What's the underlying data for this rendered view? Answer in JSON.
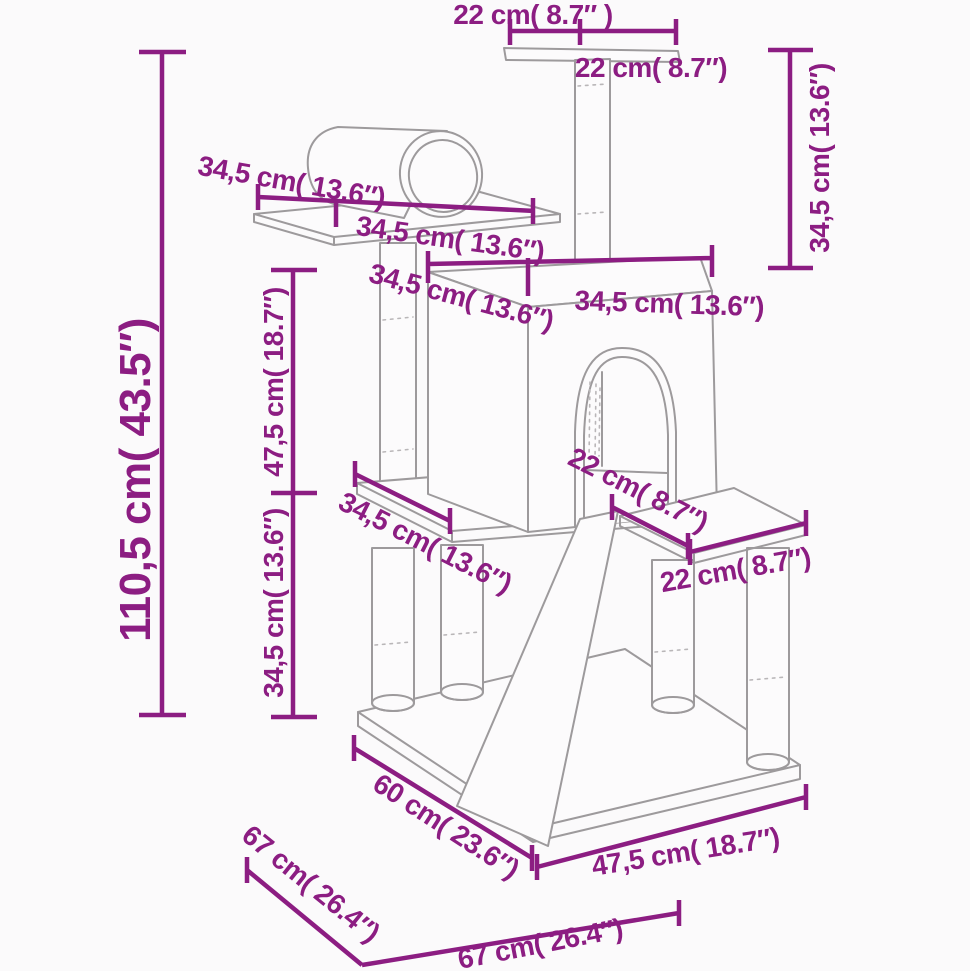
{
  "figure": {
    "type": "product dimension diagram",
    "subject": "cat tree with scratching posts, house, tunnel, ramp and perch"
  },
  "colors": {
    "dimension_accent": "#8C1D82",
    "line_art": "#9D9A9C",
    "background": "#FBFAFB"
  },
  "labels": {
    "top_width_left": "22 cm( 8.7″ )",
    "top_width_right": "22 cm( 8.7″)",
    "top_post_height": "34,5 cm( 13.6″)",
    "tunnel_length": "34,5 cm( 13.6″)",
    "tunnel_platform_width": "34,5 cm( 13.6″)",
    "house_depth": "34,5 cm( 13.6″)",
    "house_width": "34,5 cm( 13.6″)",
    "total_height": "110,5 cm( 43.5″)",
    "upper_section_height": "47,5 cm( 18.7″)",
    "lower_section_height": "34,5 cm( 13.6″)",
    "right_platform_depth": "22 cm( 8.7″)",
    "left_platform_width": "34,5 cm( 13.6″)",
    "right_platform_width": "22 cm( 8.7″)",
    "base_depth_inner": "60 cm( 23.6″)",
    "base_depth_outer": "67 cm( 26.4″)",
    "base_width_inner": "47,5 cm( 18.7″)",
    "base_width_outer": "67 cm( 26.4″)"
  },
  "measurements": [
    {
      "part": "total height",
      "cm": 110.5,
      "inch": 43.5
    },
    {
      "part": "upper section height",
      "cm": 47.5,
      "inch": 18.7
    },
    {
      "part": "lower section height",
      "cm": 34.5,
      "inch": 13.6
    },
    {
      "part": "top post height",
      "cm": 34.5,
      "inch": 13.6
    },
    {
      "part": "top perch",
      "cm": 22,
      "inch": 8.7
    },
    {
      "part": "tunnel / platform",
      "cm": 34.5,
      "inch": 13.6
    },
    {
      "part": "house top",
      "cm": 34.5,
      "inch": 13.6
    },
    {
      "part": "step platform",
      "cm": 22,
      "inch": 8.7
    },
    {
      "part": "base inner depth",
      "cm": 60,
      "inch": 23.6
    },
    {
      "part": "base inner width",
      "cm": 47.5,
      "inch": 18.7
    },
    {
      "part": "base outer depth",
      "cm": 67,
      "inch": 26.4
    },
    {
      "part": "base outer width",
      "cm": 67,
      "inch": 26.4
    }
  ]
}
